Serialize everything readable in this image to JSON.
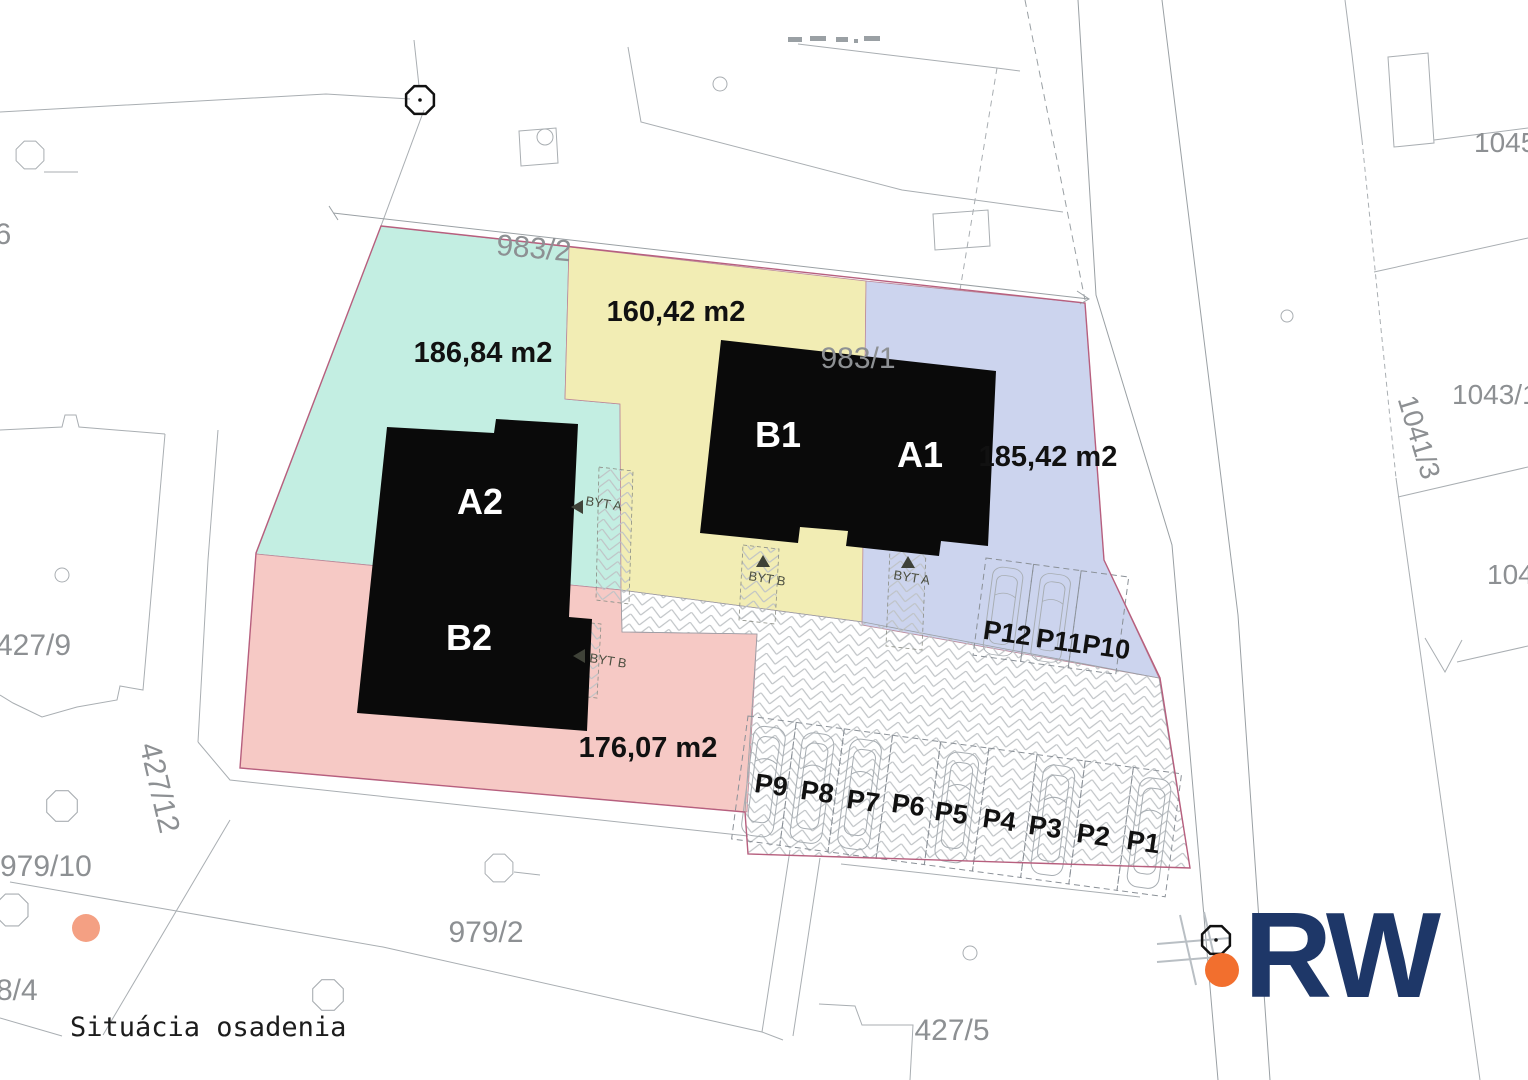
{
  "title": "Situácia osadenia",
  "logo": {
    "text": "RW"
  },
  "colors": {
    "teal": "#c3eee2",
    "yellow": "#f2edb4",
    "blue": "#ccd4ee",
    "pink": "#f6c9c5",
    "building": "#0a0a0a",
    "navy": "#1e3768",
    "orange": "#f26f2e",
    "tree": "#f4a083",
    "parcel_text": "#8d9093",
    "boundary": "#b75f7e",
    "byt": "#4c4f41",
    "area_text": "#111111"
  },
  "zones": {
    "teal": {
      "area": "186,84 m2"
    },
    "yellow": {
      "area": "160,42 m2"
    },
    "blue": {
      "area": "185,42 m2"
    },
    "pink": {
      "area": "176,07 m2"
    }
  },
  "buildings": {
    "a2": "A2",
    "b2": "B2",
    "b1": "B1",
    "a1": "A1"
  },
  "byt": {
    "a": "BYT A",
    "b": "BYT B"
  },
  "parking": {
    "p1": "P1",
    "p2": "P2",
    "p3": "P3",
    "p4": "P4",
    "p5": "P5",
    "p6": "P6",
    "p7": "P7",
    "p8": "P8",
    "p9": "P9",
    "p10": "P10",
    "p11": "P11",
    "p12": "P12"
  },
  "parcels": {
    "p983_1": "983/1",
    "p983_2": "983/2",
    "p96": "96",
    "p1045": "1045",
    "p1043_1": "1043/1",
    "p1041_3": "1041/3",
    "p104": "104",
    "p427_9": "427/9",
    "p427_12": "427/12",
    "p979_10": "979/10",
    "p8_4": "8/4",
    "p979_2": "979/2",
    "p427_5": "427/5"
  }
}
